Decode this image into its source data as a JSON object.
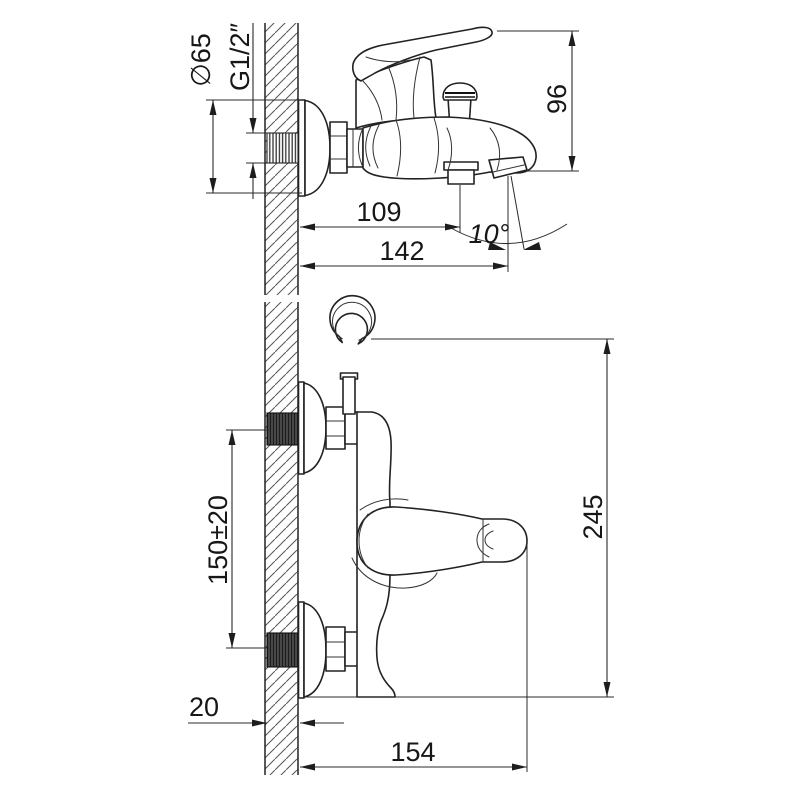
{
  "drawing": {
    "colors": {
      "background": "#ffffff",
      "line": "#222222",
      "dimension": "#2b2b2b",
      "text": "#171717",
      "hatch": "#555555"
    },
    "side_view": {
      "dims": {
        "flange_diameter": "∅65",
        "thread_size": "G1/2″",
        "height": "96",
        "depth_shower_outlet": "109",
        "depth_spout": "142",
        "spout_angle": "10°"
      }
    },
    "front_view": {
      "dims": {
        "supply_spacing": "150±20",
        "overall_height": "245",
        "wall_thickness": "20",
        "overall_depth": "154"
      }
    }
  }
}
